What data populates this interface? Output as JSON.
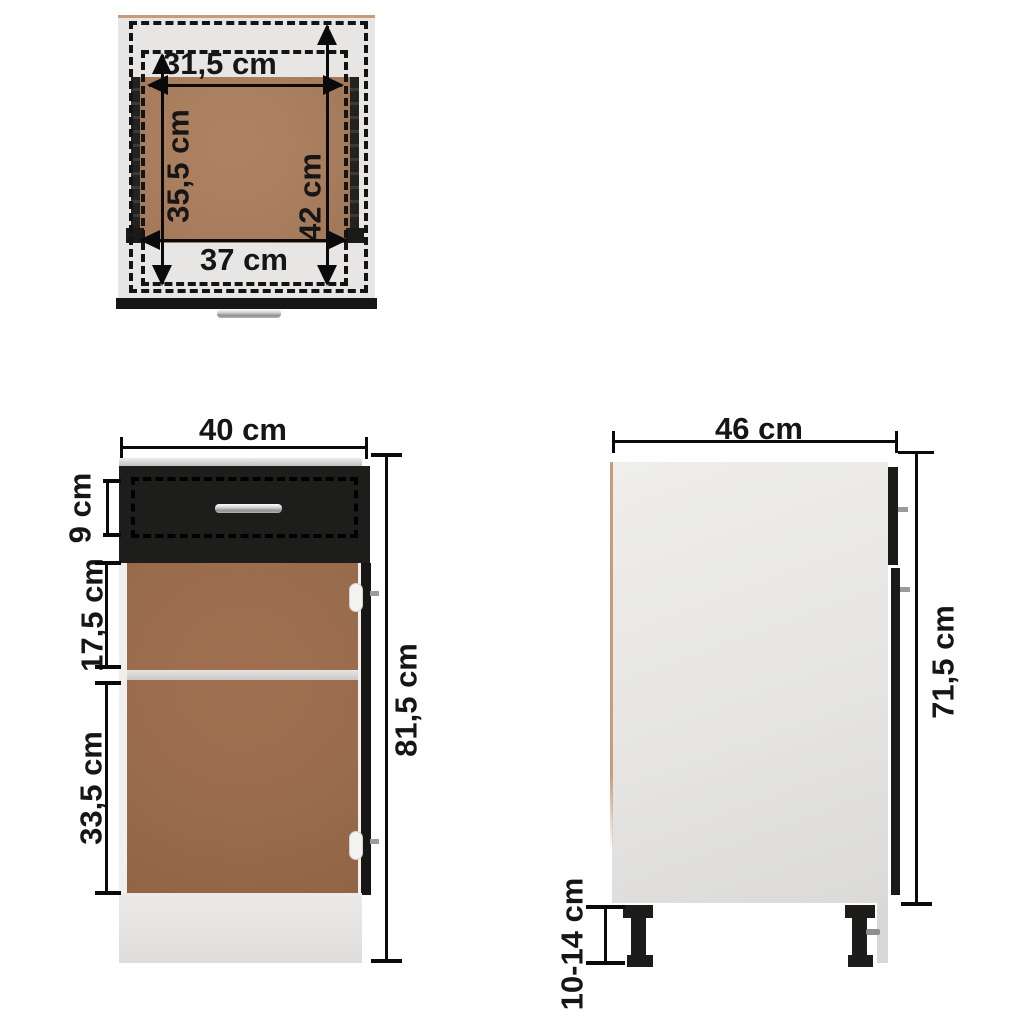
{
  "diagram": {
    "title": "Kitchen base cabinet with drawer - dimension diagram",
    "unit": "cm",
    "colors": {
      "carcass_gray": "#e7e6e4",
      "front_black": "#1c1c1b",
      "interior_brown": "#9a6c4e",
      "drawer_bottom_brown": "#a87e5e",
      "handle_silver": "#d9d9d9",
      "edge_tan": "#c79c78",
      "dimension_black": "#0a0a0a"
    }
  },
  "views": {
    "top": {
      "name": "top-view-drawer",
      "dims": [
        {
          "id": "drawer-inner-width",
          "label": "31,5 cm"
        },
        {
          "id": "drawer-inner-depth",
          "label": "35,5 cm"
        },
        {
          "id": "drawer-total-depth",
          "label": "42 cm"
        },
        {
          "id": "drawer-outer-width",
          "label": "37 cm"
        }
      ]
    },
    "front": {
      "name": "front-view",
      "dims": [
        {
          "id": "cabinet-width",
          "label": "40 cm"
        },
        {
          "id": "drawer-front-height",
          "label": "9 cm"
        },
        {
          "id": "upper-compartment-height",
          "label": "17,5 cm"
        },
        {
          "id": "lower-compartment-height",
          "label": "33,5 cm"
        },
        {
          "id": "total-height",
          "label": "81,5 cm"
        }
      ]
    },
    "side": {
      "name": "side-view",
      "dims": [
        {
          "id": "cabinet-depth",
          "label": "46 cm"
        },
        {
          "id": "body-height",
          "label": "71,5 cm"
        },
        {
          "id": "leg-height-adjustable",
          "label": "10-14 cm"
        }
      ]
    }
  }
}
